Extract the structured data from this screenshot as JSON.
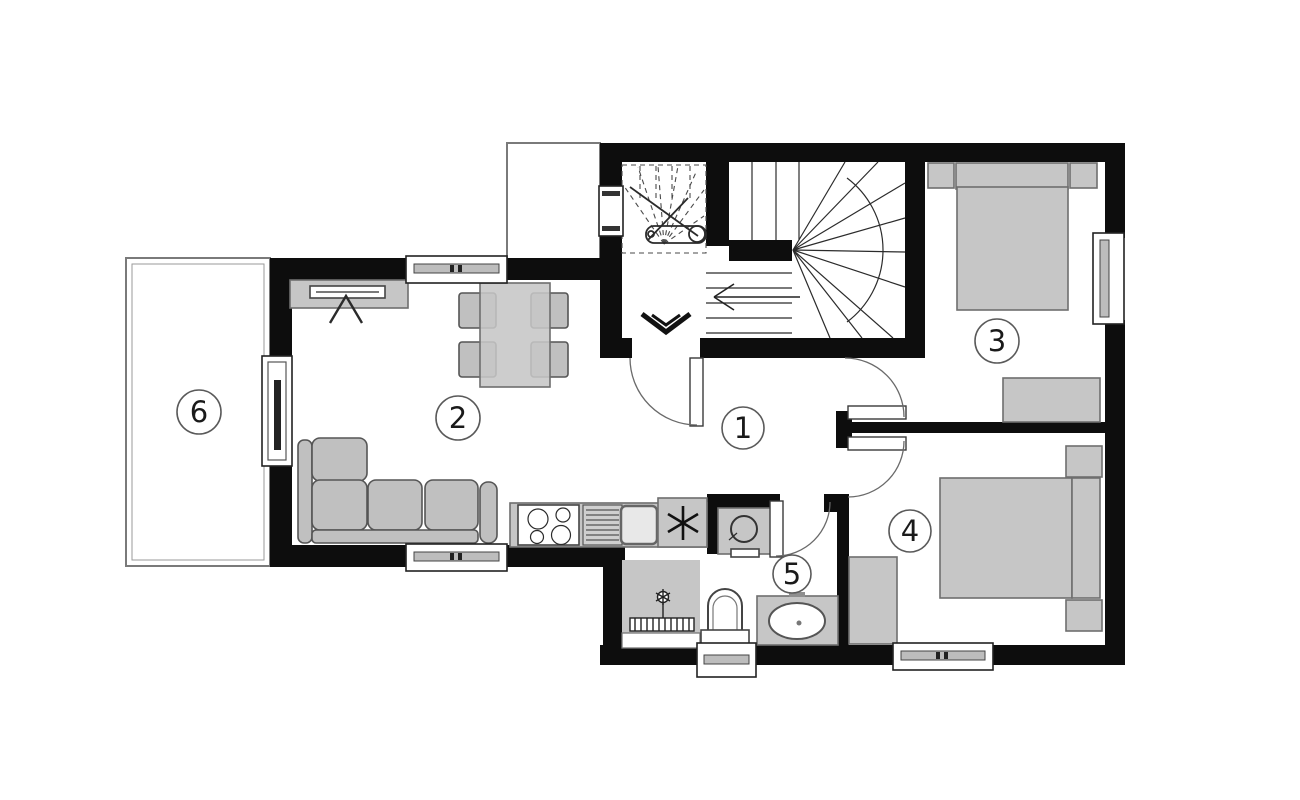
{
  "plan": {
    "title": "apartment floor plan",
    "colors": {
      "wall": "#0d0d0d",
      "furniture_fill": "#c6c6c6",
      "furniture_border": "#6e6e6e",
      "line": "#2b2b2b",
      "background": "#ffffff"
    },
    "rooms": [
      {
        "id": "hallway",
        "label": "1",
        "fixtures": [
          "door-arc-to-bedroom-3",
          "door-arc-to-bedroom-4",
          "door-arc-to-bathroom",
          "door-arc-from-stairs"
        ]
      },
      {
        "id": "living-room",
        "label": "2",
        "fixtures": [
          "tv-cabinet",
          "tv",
          "antenna-mark",
          "dining-table",
          "chair",
          "chair",
          "chair",
          "chair",
          "corner-sofa",
          "window-top",
          "window-bottom",
          "balcony-door"
        ]
      },
      {
        "id": "bedroom-top",
        "label": "3",
        "fixtures": [
          "double-bed",
          "nightstand",
          "nightstand",
          "wardrobe",
          "window-right"
        ]
      },
      {
        "id": "bedroom-bottom",
        "label": "4",
        "fixtures": [
          "double-bed",
          "headboard",
          "nightstand",
          "nightstand",
          "wardrobe",
          "window-bottom"
        ]
      },
      {
        "id": "bathroom",
        "label": "5",
        "fixtures": [
          "washing-machine",
          "shower-drying-area",
          "towel-rack",
          "toilet",
          "toilet-window",
          "washbasin-counter",
          "washbasin"
        ]
      },
      {
        "id": "terrace",
        "label": "6",
        "fixtures": []
      }
    ],
    "stairs": {
      "main": [
        "winder-treads",
        "walkline-arc",
        "direction-arrow-left"
      ],
      "lobby": [
        "dashed-stair-above",
        "pram-symbol",
        "entry-arrow-down",
        "entrance-door",
        "porch-outline"
      ]
    }
  }
}
